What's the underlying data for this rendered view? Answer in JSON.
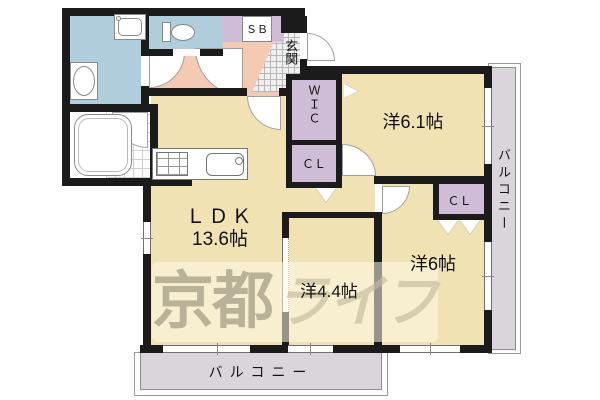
{
  "plan": {
    "title": "apartment-floor-plan",
    "rooms": {
      "ldk": {
        "name": "ＬＤＫ",
        "size": "13.6帖"
      },
      "bedroom61": {
        "label": "洋6.1帖"
      },
      "bedroom6": {
        "label": "洋6帖"
      },
      "bedroom44": {
        "label": "洋4.4帖"
      },
      "entrance": {
        "label": "玄関"
      },
      "wic": {
        "label": "ＷＩＣ"
      },
      "closet1": {
        "label": "ＣＬ"
      },
      "closet2": {
        "label": "ＣＬ"
      },
      "shoebox": {
        "label": "ＳＢ"
      },
      "balcony_bottom": {
        "label": "バルコニー"
      },
      "balcony_right": {
        "label": "バルコニー"
      }
    },
    "watermark": {
      "part1": "京都",
      "part2": "ライフ"
    },
    "colors": {
      "room_tan": "#f1e2b3",
      "wet_blue": "#b0cddb",
      "hall_pink": "#f5cab3",
      "closet_purple": "#cfbdd8",
      "balcony_gray": "#d9d5da",
      "wall_black": "#1b1b1b"
    }
  }
}
